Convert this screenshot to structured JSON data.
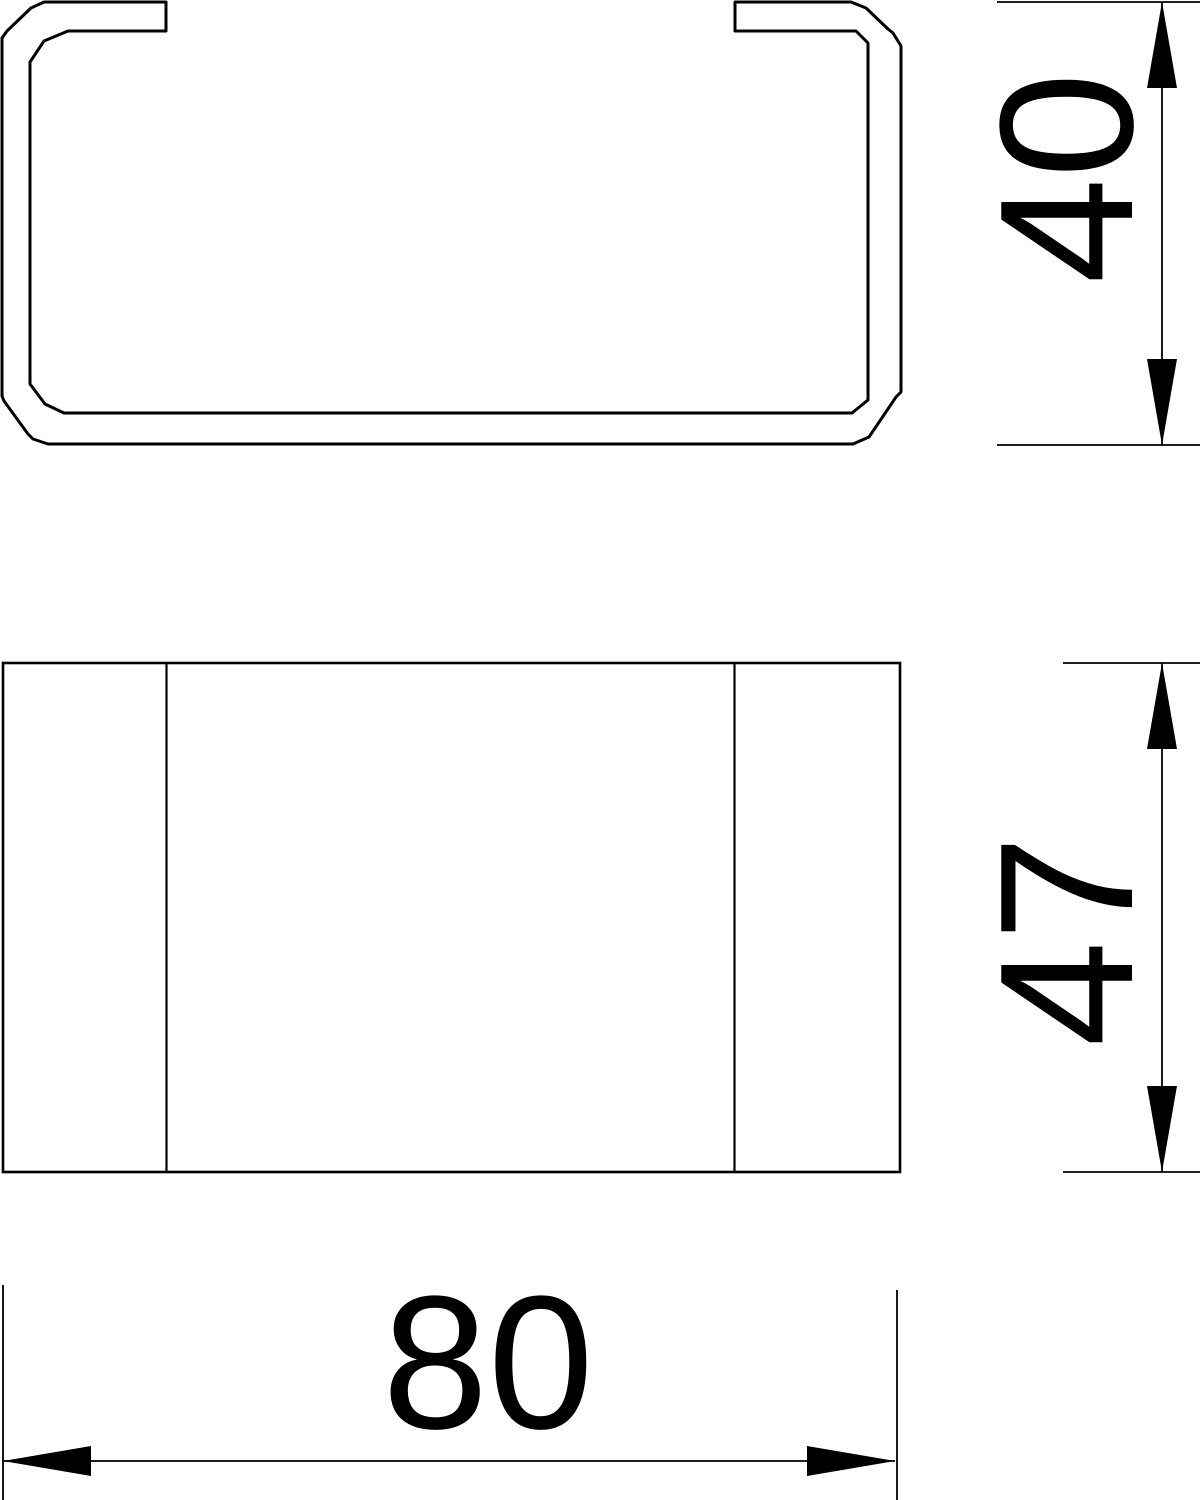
{
  "drawing": {
    "kind": "technical-dimension-drawing",
    "background_color": "#ffffff",
    "line_color": "#000000",
    "views": {
      "cross_section": {
        "description": "C-shaped duct profile cross-section, top view"
      },
      "front": {
        "description": "front view rectangle with slot edge lines"
      }
    },
    "dimensions": {
      "height": {
        "value": "40",
        "orientation": "vertical",
        "applies_to": "cross_section"
      },
      "depth": {
        "value": "47",
        "orientation": "vertical",
        "applies_to": "front"
      },
      "width": {
        "value": "80",
        "orientation": "horizontal",
        "applies_to": "front"
      }
    }
  }
}
